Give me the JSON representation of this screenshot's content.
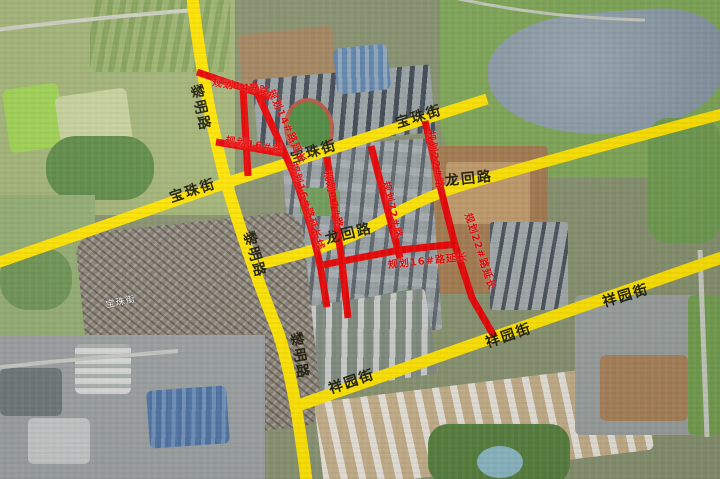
{
  "map": {
    "colors": {
      "major_road": "#ffe400",
      "planned_road": "#e80202",
      "major_label_text": "#1d1c06",
      "planned_label_text": "#e60000",
      "basemap_label_text": "#ffffff"
    },
    "roads": {
      "major": [
        {
          "name": "黎明路"
        },
        {
          "name": "宝珠街"
        },
        {
          "name": "龙回路"
        },
        {
          "name": "祥园街"
        }
      ],
      "planned": [
        {
          "name": "规划14#路"
        },
        {
          "name": "规划14#路延长"
        },
        {
          "name": "规划16#路"
        },
        {
          "name": "规划16#路延长线"
        },
        {
          "name": "规划16#路延长"
        },
        {
          "name": "规划17#路"
        },
        {
          "name": "规划72#路"
        },
        {
          "name": "规划22#路"
        },
        {
          "name": "规划22#路延长"
        }
      ]
    },
    "major_road_labels": [
      {
        "text": "黎明路"
      },
      {
        "text": "黎明路"
      },
      {
        "text": "黎明路"
      },
      {
        "text": "宝珠街"
      },
      {
        "text": "宝珠街"
      },
      {
        "text": "宝珠街"
      },
      {
        "text": "龙回路"
      },
      {
        "text": "龙回路"
      },
      {
        "text": "祥园街"
      },
      {
        "text": "祥园街"
      },
      {
        "text": "祥园街"
      }
    ],
    "planned_road_labels": [
      {
        "text": "规划14#路"
      },
      {
        "text": "规划14#路延长"
      },
      {
        "text": "规划16#路"
      },
      {
        "text": "规划16#路延长线"
      },
      {
        "text": "规划17#路"
      },
      {
        "text": "规划72#路"
      },
      {
        "text": "规划22#路"
      },
      {
        "text": "规划22#路延长"
      },
      {
        "text": "规划16#路延长"
      }
    ],
    "basemap_labels": [
      {
        "text": "宝珠街"
      }
    ]
  }
}
